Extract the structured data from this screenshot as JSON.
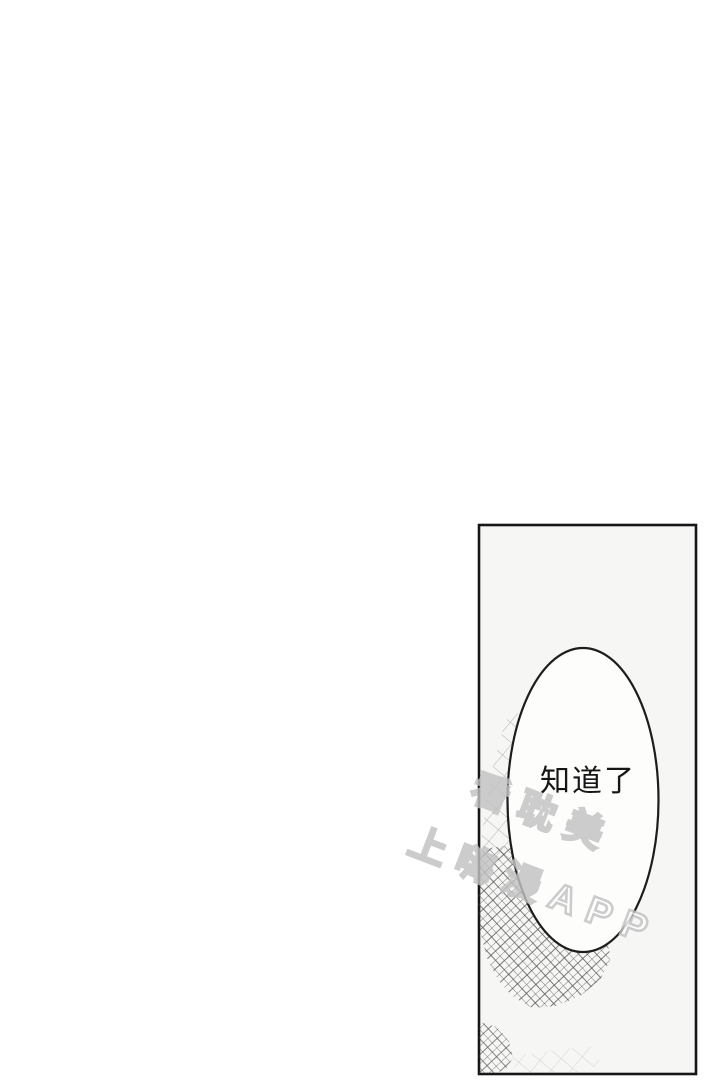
{
  "page": {
    "background_color": "#ffffff"
  },
  "panel": {
    "fill_color": "#f6f6f5",
    "border_color": "#171717",
    "crosshatch_line_color": "#3a3a3a"
  },
  "speech_bubble": {
    "text": "知道了",
    "fill_color": "#fdfdfc",
    "stroke_color": "#1d1d1d",
    "text_color": "#161616"
  },
  "watermark": {
    "line1": "看耽美",
    "line2": "上嗨漫APP",
    "text_color": "#ffffff",
    "outline_color": "#c2c2c2"
  }
}
